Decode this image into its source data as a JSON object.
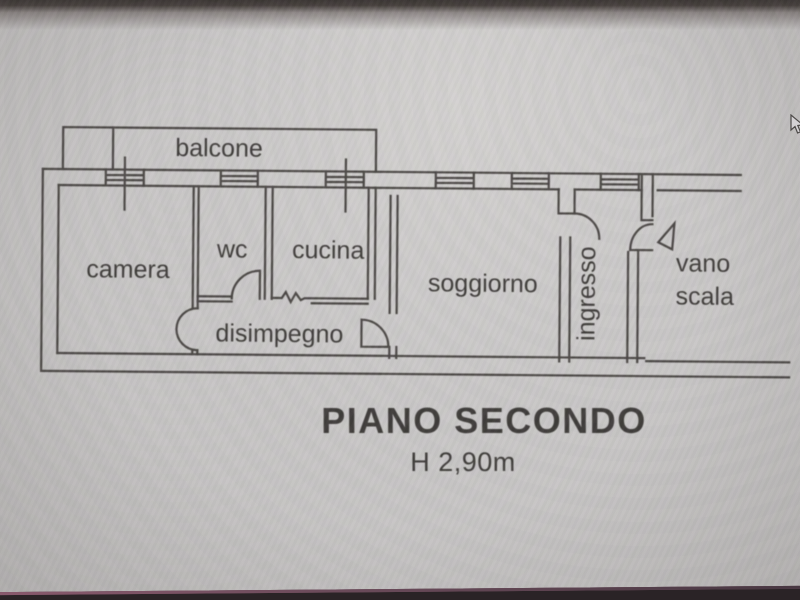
{
  "floor_plan": {
    "rooms": {
      "balcone": "balcone",
      "camera": "camera",
      "wc": "wc",
      "cucina": "cucina",
      "disimpegno": "disimpegno",
      "soggiorno": "soggiorno",
      "ingresso": "ingresso",
      "vano_scala_line1": "vano",
      "vano_scala_line2": "scala"
    },
    "caption": {
      "title": "PIANO SECONDO",
      "height_note": "H 2,90m"
    },
    "colors": {
      "line": "#403c39",
      "text": "#33302d",
      "background": "#cbc9c7",
      "top_band": "#2e2825",
      "bottom_band": "#2a2326",
      "bottom_accent": "#7b5364"
    }
  },
  "icons": {
    "cursor": "arrow-pointer"
  }
}
